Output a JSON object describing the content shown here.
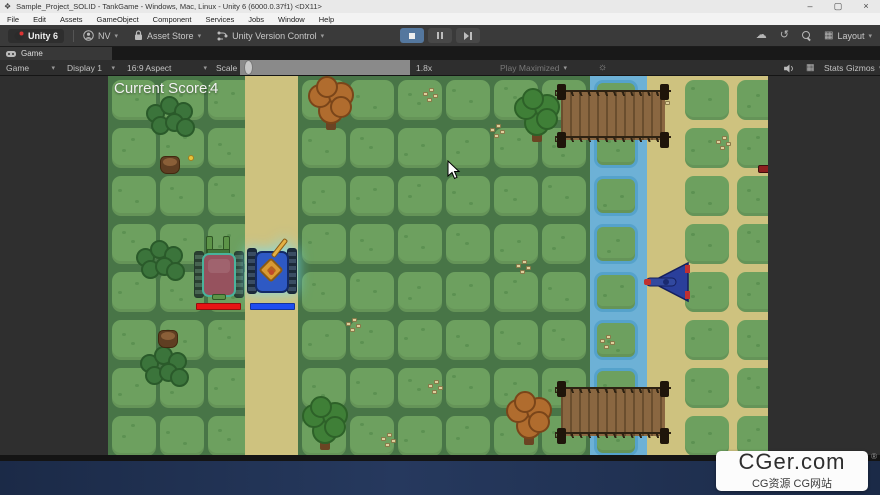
{
  "window": {
    "title": "Sample_Project_SOLID - TankGame - Windows, Mac, Linux - Unity 6 (6000.0.37f1) <DX11>",
    "minimize": "–",
    "maximize": "▢",
    "close": "×"
  },
  "menu": [
    "File",
    "Edit",
    "Assets",
    "GameObject",
    "Component",
    "Services",
    "Jobs",
    "Window",
    "Help"
  ],
  "toolbar": {
    "unity_version": "Unity 6",
    "account": "NV",
    "asset_store": "Asset Store",
    "version_control": "Unity Version Control",
    "layout": "Layout"
  },
  "icons": {
    "dropdown": "▾",
    "cloud": "☁",
    "history": "↺",
    "grid": "▦",
    "sun": "☼"
  },
  "tab": {
    "label": "Game"
  },
  "game_toolbar": {
    "view": "Game",
    "display": "Display 1",
    "aspect": "16:9 Aspect",
    "scale_label": "Scale",
    "scale_value": "1.8x",
    "play_maximized": "Play Maximized",
    "stats": "Stats",
    "gizmos": "Gizmos"
  },
  "hud": {
    "score_label": "Current Score:",
    "score_value": "4"
  },
  "watermark": {
    "title": "CGer.com",
    "subtitle": "CG资源 CG网站",
    "reg": "®"
  },
  "colors": {
    "grass_bg": "#487547",
    "tile": "#6da05f",
    "tile_dot": "#5c9152",
    "road": "#cec27f",
    "water": "#6db1d6",
    "water_border": "#55a2cb",
    "bridge_plank_a": "#6a4e2e",
    "bridge_plank_b": "#8a6741",
    "bridge_rail": "#2e2212",
    "bridge_post": "#1f150a",
    "bush": "#3b743b",
    "bush_line": "#2a5a2a",
    "tree_green": "#3f7f37",
    "tree_green_line": "#2d6128",
    "tree_orange": "#b06c2e",
    "tree_orange_line": "#7a4519",
    "trunk": "#6b4423",
    "stump": "#5f3e22",
    "stump_top": "#8a5f38",
    "speckle": "#ddcf9b",
    "speckle_line": "#8a7a4a",
    "flower": "#e8c43a",
    "enemy_hull": "#96525e",
    "enemy_rim": "#49b39b",
    "enemy_track": "#3c5a46",
    "enemy_barrel": "#5d9448",
    "player_hull": "#2e59c4",
    "player_track": "#2b4057",
    "player_turret": "#d89a33",
    "player_barrel": "#e3b045",
    "health_red": "#e81414",
    "health_blue": "#1f4df0",
    "jet_body": "#2a3f9b",
    "jet_line": "#141f5e",
    "jet_red": "#c03030",
    "pickup": "#8c1f1f"
  },
  "map": {
    "tile": {
      "w": 44,
      "h": 40,
      "radius": 9
    },
    "row_ys": [
      4,
      52,
      100,
      148,
      196,
      244,
      292,
      340
    ],
    "green_cols_x": [
      4,
      52,
      100,
      194,
      242,
      290,
      338,
      386,
      434
    ],
    "river_col_x": 486,
    "right_cols_x": [
      577,
      629
    ],
    "roads": [
      {
        "x": 137,
        "w": 53
      },
      {
        "x": 539,
        "w": 121
      }
    ],
    "river": {
      "x": 482,
      "w": 57
    },
    "bridges": [
      {
        "x": 453,
        "y": 16,
        "w": 104,
        "h": 48
      },
      {
        "x": 453,
        "y": 313,
        "w": 104,
        "h": 47
      }
    ],
    "bushes": [
      {
        "x": 38,
        "y": 20
      },
      {
        "x": 28,
        "y": 164
      },
      {
        "x": 32,
        "y": 270
      }
    ],
    "stumps": [
      {
        "x": 52,
        "y": 80
      },
      {
        "x": 50,
        "y": 254
      }
    ],
    "flowers": [
      {
        "x": 80,
        "y": 79
      }
    ],
    "trees": [
      {
        "x": 200,
        "y": 0,
        "variant": "orange"
      },
      {
        "x": 406,
        "y": 12,
        "variant": "green"
      },
      {
        "x": 194,
        "y": 320,
        "variant": "green"
      },
      {
        "x": 398,
        "y": 315,
        "variant": "orange"
      }
    ],
    "speckles": [
      {
        "x": 315,
        "y": 12
      },
      {
        "x": 382,
        "y": 48
      },
      {
        "x": 408,
        "y": 184
      },
      {
        "x": 238,
        "y": 242
      },
      {
        "x": 320,
        "y": 304
      },
      {
        "x": 273,
        "y": 357
      },
      {
        "x": 492,
        "y": 259
      },
      {
        "x": 547,
        "y": 19
      },
      {
        "x": 608,
        "y": 60
      }
    ],
    "enemy_tank": {
      "x": 86,
      "y": 160
    },
    "enemy_health": {
      "x": 88,
      "y": 227,
      "w": 45,
      "h": 7
    },
    "player_tank": {
      "x": 139,
      "y": 166
    },
    "player_health": {
      "x": 142,
      "y": 227,
      "w": 45,
      "h": 7
    },
    "jet": {
      "x": 533,
      "y": 184
    },
    "pickup": {
      "x": 650,
      "y": 89
    }
  }
}
